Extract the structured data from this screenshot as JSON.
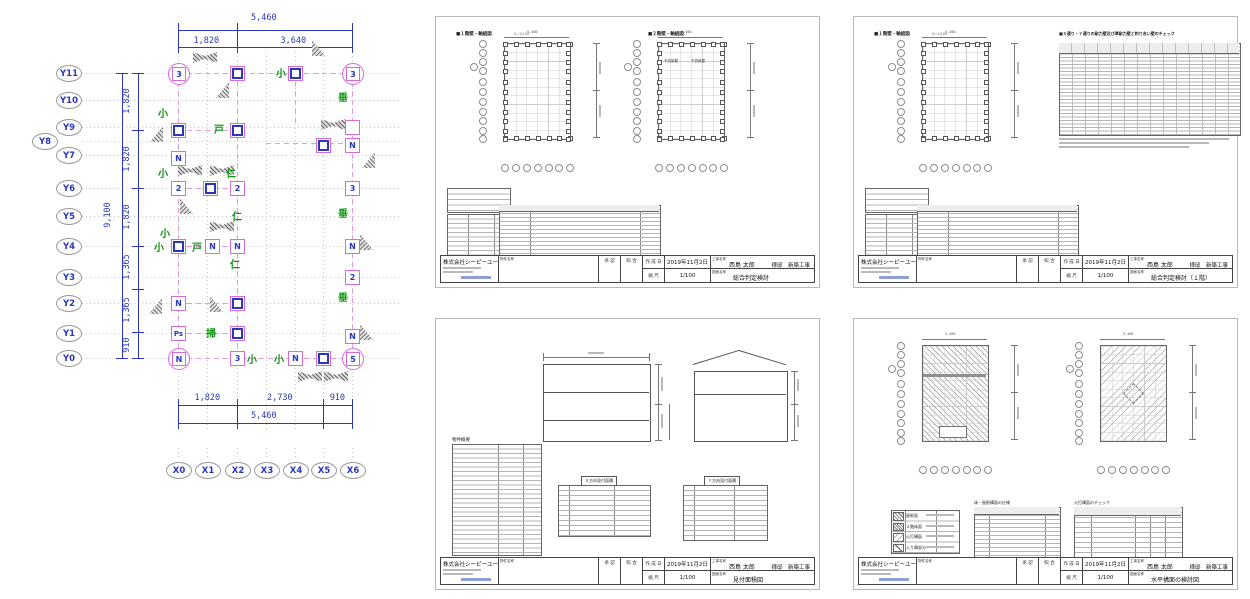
{
  "plan": {
    "colors": {
      "dimension_blue": "#2936bd",
      "grid_gray": "#c6c6c6",
      "column_magenta": "#d66ad6",
      "label_green": "#109410"
    },
    "grid_x": [
      178,
      207,
      237,
      266,
      295,
      323,
      352
    ],
    "x_labels": [
      "X0",
      "X1",
      "X2",
      "X3",
      "X4",
      "X5",
      "X6"
    ],
    "rows": [
      [
        "Y11",
        73
      ],
      [
        "Y10",
        100
      ],
      [
        "Y9",
        127
      ],
      [
        "Y8",
        141
      ],
      [
        "Y7",
        155
      ],
      [
        "Y6",
        188
      ],
      [
        "Y5",
        216
      ],
      [
        "Y4",
        246
      ],
      [
        "Y3",
        277
      ],
      [
        "Y2",
        303
      ],
      [
        "Y1",
        333
      ],
      [
        "Y0",
        358
      ]
    ],
    "dims_top": {
      "total": "5,460",
      "segs": [
        [
          "1,820",
          178,
          237
        ],
        [
          "3,640",
          237,
          352
        ]
      ]
    },
    "dims_bottom": {
      "total": "5,460",
      "segs": [
        [
          "1,820",
          178,
          237
        ],
        [
          "2,730",
          237,
          323
        ],
        [
          "910",
          323,
          352
        ]
      ]
    },
    "dims_left": {
      "total": "9,100",
      "segs": [
        [
          "1,820",
          101
        ],
        [
          "1,820",
          159
        ],
        [
          "1,820",
          217
        ],
        [
          "1,365",
          267
        ],
        [
          "1,365",
          310
        ],
        [
          "910",
          345
        ]
      ],
      "ticks": [
        73,
        130,
        188,
        246,
        289,
        332,
        358
      ]
    },
    "markers": [
      [
        "ci",
        "3",
        178,
        73
      ],
      [
        "sq",
        "",
        237,
        73
      ],
      [
        "sq",
        "",
        295,
        73
      ],
      [
        "ci",
        "3",
        352,
        73
      ],
      [
        "sq",
        "",
        178,
        130
      ],
      [
        "sq",
        "",
        237,
        130
      ],
      [
        "bo",
        "",
        352,
        127
      ],
      [
        "sq",
        "",
        323,
        145
      ],
      [
        "bx",
        "N",
        352,
        145
      ],
      [
        "bx",
        "N",
        178,
        158
      ],
      [
        "bx",
        "2",
        178,
        188
      ],
      [
        "sq",
        "",
        210,
        188
      ],
      [
        "bx",
        "2",
        237,
        188
      ],
      [
        "bx",
        "3",
        352,
        188
      ],
      [
        "sq",
        "",
        178,
        246
      ],
      [
        "bx",
        "N",
        212,
        246
      ],
      [
        "bx",
        "N",
        237,
        246
      ],
      [
        "bx",
        "N",
        352,
        246
      ],
      [
        "bx",
        "2",
        352,
        277
      ],
      [
        "bx",
        "N",
        178,
        303
      ],
      [
        "sq",
        "",
        237,
        303
      ],
      [
        "bx",
        "Ps",
        178,
        333
      ],
      [
        "sq",
        "",
        237,
        333
      ],
      [
        "bx",
        "N",
        352,
        336
      ],
      [
        "ci",
        "N",
        178,
        358
      ],
      [
        "bx",
        "3",
        237,
        358
      ],
      [
        "bx",
        "N",
        295,
        358
      ],
      [
        "sq",
        "",
        323,
        358
      ],
      [
        "ci",
        "5",
        352,
        358
      ]
    ],
    "greens": [
      [
        "小",
        276,
        65
      ],
      [
        "小",
        158,
        105
      ],
      [
        "垂",
        338,
        89
      ],
      [
        "戸",
        214,
        121
      ],
      [
        "小",
        158,
        165
      ],
      [
        "仁",
        226,
        165
      ],
      [
        "垂",
        338,
        205
      ],
      [
        "仁",
        232,
        208
      ],
      [
        "小",
        160,
        225
      ],
      [
        "小",
        154,
        239
      ],
      [
        "戸",
        192,
        239
      ],
      [
        "仁",
        230,
        256
      ],
      [
        "垂",
        338,
        289
      ],
      [
        "掃",
        206,
        325
      ],
      [
        "小",
        247,
        351
      ],
      [
        "小",
        274,
        351
      ]
    ],
    "dashes_h": [
      [
        178,
        352,
        73
      ],
      [
        178,
        237,
        130
      ],
      [
        266,
        352,
        143
      ],
      [
        178,
        237,
        188
      ],
      [
        178,
        237,
        246
      ],
      [
        178,
        237,
        303
      ],
      [
        178,
        237,
        333
      ],
      [
        178,
        352,
        358
      ]
    ],
    "dashes_v": [
      [
        178,
        73,
        358
      ],
      [
        237,
        73,
        358
      ],
      [
        352,
        73,
        358
      ],
      [
        295,
        73,
        127
      ]
    ],
    "bowties": [
      [
        205,
        57
      ],
      [
        333,
        124
      ],
      [
        190,
        170
      ],
      [
        222,
        170
      ],
      [
        222,
        226
      ],
      [
        310,
        376
      ],
      [
        336,
        376
      ]
    ],
    "tris": [
      [
        318,
        48,
        1
      ],
      [
        222,
        90,
        0
      ],
      [
        156,
        134,
        0
      ],
      [
        186,
        206,
        1
      ],
      [
        155,
        306,
        0
      ],
      [
        216,
        304,
        1
      ],
      [
        366,
        242,
        1
      ],
      [
        366,
        332,
        1
      ],
      [
        368,
        160,
        0
      ]
    ]
  },
  "sheets": [
    {
      "x": 435,
      "y": 16,
      "kind": "A",
      "h1": "■１階壁・軸組図",
      "h2": "■２階壁・軸組図",
      "scale_note": "S=1/100",
      "rooms": [
        "子供部屋",
        "子供部屋"
      ],
      "dwg": "総合判定検討"
    },
    {
      "x": 853,
      "y": 16,
      "kind": "B",
      "h1": "■１階壁・軸組図",
      "h2": "■Ｘ通り・Ｙ通りの耐力壁及び準耐力壁と釣り合い壁のチェック",
      "scale_note": "S=1/100",
      "dwg": "総合判定検討（１階）"
    },
    {
      "x": 435,
      "y": 318,
      "kind": "C",
      "t1": "物件概要",
      "mt1": "Ｘ方向見付面積",
      "mt2": "Ｙ方向見付面積",
      "dwg": "見付面積図"
    },
    {
      "x": 853,
      "y": 318,
      "kind": "D",
      "legend": [
        "屋根面",
        "２階床面",
        "火打構面",
        "入り隅部分"
      ],
      "mt1": "床・屋根構面の仕様",
      "mt2": "火打構面のチェック",
      "dwg": "水平構面の検討図"
    }
  ],
  "titleblock": {
    "company": "株式会社シーピーユー",
    "project_label": "物件名称",
    "approve": "承 認",
    "check": "照 合",
    "date_label": "作 成 日",
    "scale_label": "縮 尺",
    "job_label": "工事名称",
    "dwg_label": "図面名称",
    "date": "2019年11月2日",
    "scale": "1/100",
    "owner": "西島 太郎",
    "owner_suffix": "様邸　新築工事",
    "mini_dim_top": "5,460"
  }
}
